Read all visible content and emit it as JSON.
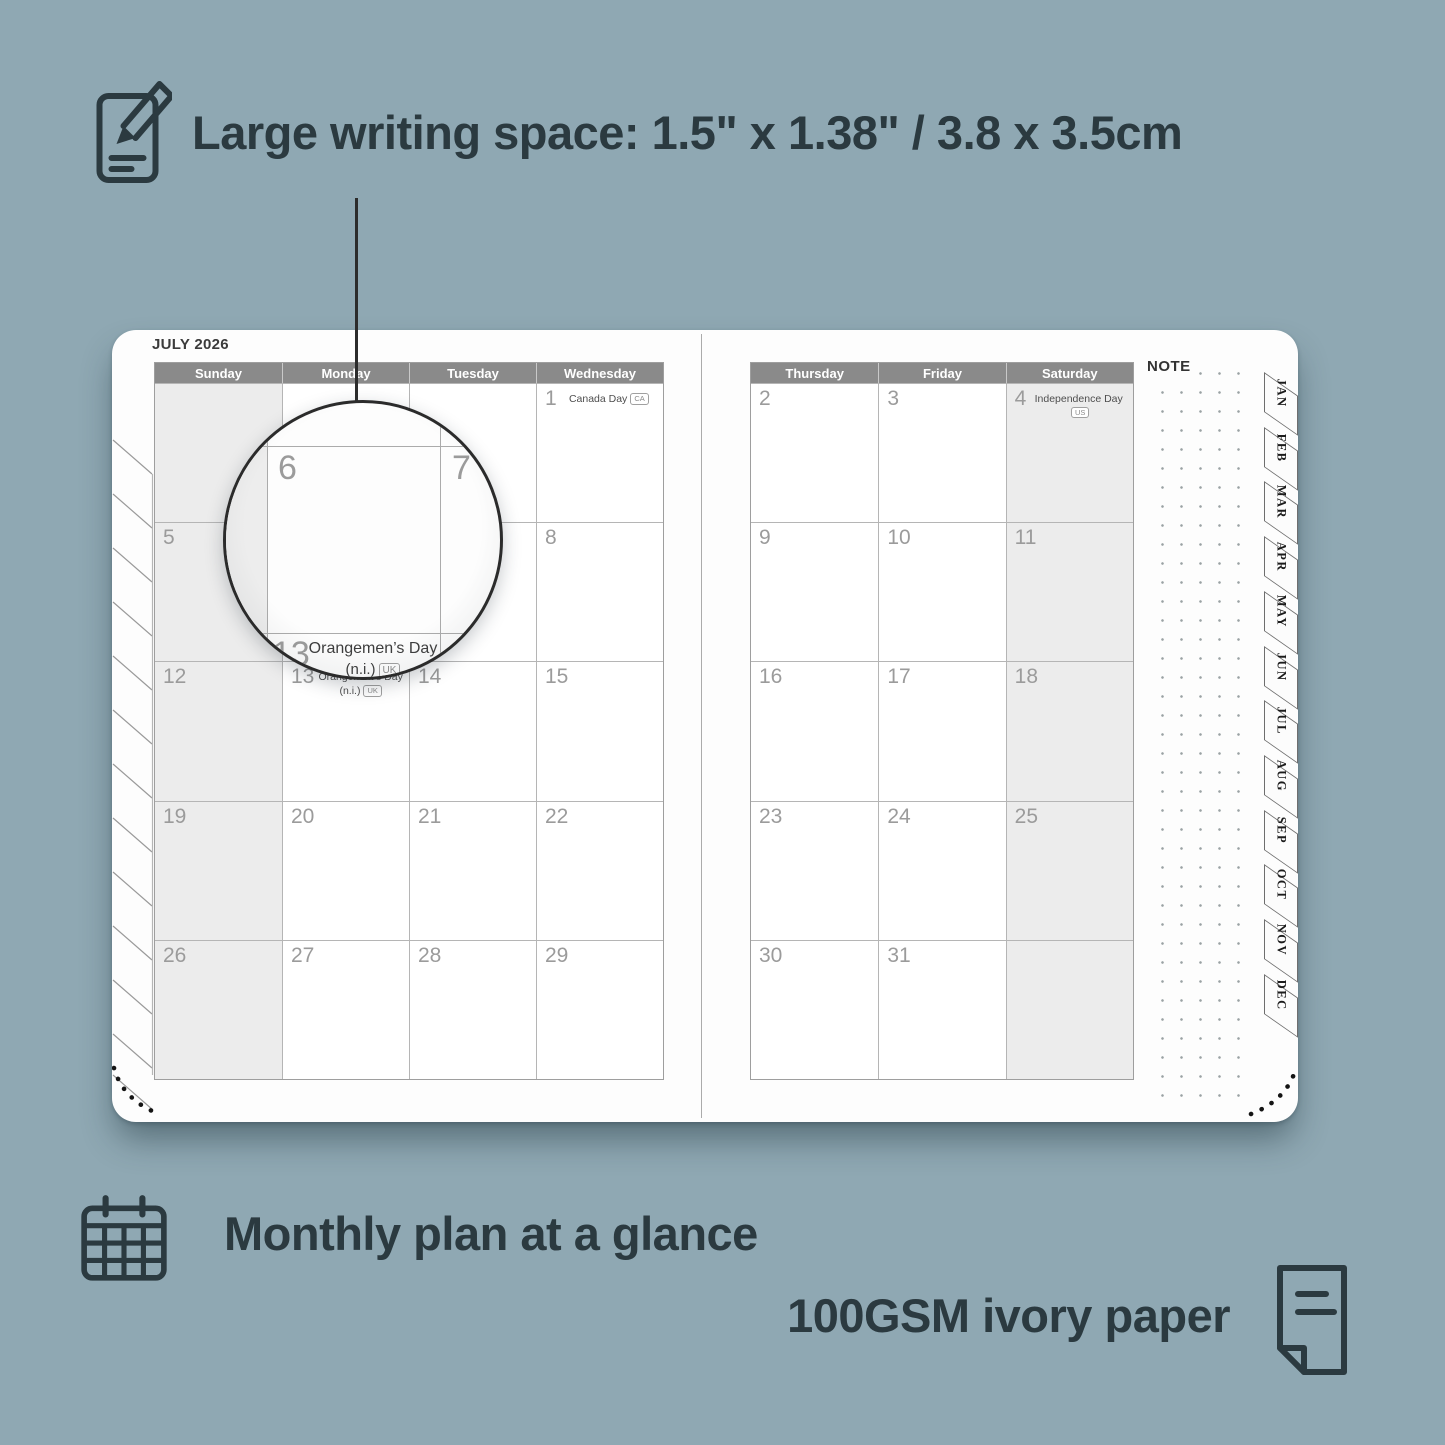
{
  "colors": {
    "background": "#8FA8B3",
    "ink": "#2B3A40",
    "header_bar": "#8A8A8A",
    "cell_shade": "#ECECEC",
    "page": "#FDFDFD"
  },
  "features": {
    "writing_space_label": "Large writing space: 1.5\" x 1.38\" / 3.8 x 3.5cm",
    "monthly_plan_label": "Monthly plan at a glance",
    "paper_label": "100GSM ivory paper"
  },
  "planner": {
    "month_title": "JULY 2026",
    "note_label": "NOTE",
    "left_day_headers": [
      "Sunday",
      "Monday",
      "Tuesday",
      "Wednesday"
    ],
    "right_day_headers": [
      "Thursday",
      "Friday",
      "Saturday"
    ],
    "month_tabs": [
      "JAN",
      "FEB",
      "MAR",
      "APR",
      "MAY",
      "JUN",
      "JUL",
      "AUG",
      "SEP",
      "OCT",
      "NOV",
      "DEC"
    ],
    "left_weeks": [
      [
        {
          "day": ""
        },
        {
          "day": ""
        },
        {
          "day": ""
        },
        {
          "day": "1",
          "holiday_lines": [
            "Canada Day"
          ],
          "badge": "CA"
        }
      ],
      [
        {
          "day": "5"
        },
        {
          "day": "6"
        },
        {
          "day": "7"
        },
        {
          "day": "8"
        }
      ],
      [
        {
          "day": "12"
        },
        {
          "day": "13",
          "holiday_lines": [
            "Orangemen’s Day",
            "(n.i.)"
          ],
          "badge": "UK"
        },
        {
          "day": "14"
        },
        {
          "day": "15"
        }
      ],
      [
        {
          "day": "19"
        },
        {
          "day": "20"
        },
        {
          "day": "21"
        },
        {
          "day": "22"
        }
      ],
      [
        {
          "day": "26"
        },
        {
          "day": "27"
        },
        {
          "day": "28"
        },
        {
          "day": "29"
        }
      ]
    ],
    "right_weeks": [
      [
        {
          "day": "2"
        },
        {
          "day": "3"
        },
        {
          "day": "4",
          "holiday_lines": [
            "Independence Day"
          ],
          "badge": "US"
        }
      ],
      [
        {
          "day": "9"
        },
        {
          "day": "10"
        },
        {
          "day": "11"
        }
      ],
      [
        {
          "day": "16"
        },
        {
          "day": "17"
        },
        {
          "day": "18"
        }
      ],
      [
        {
          "day": "23"
        },
        {
          "day": "24"
        },
        {
          "day": "25"
        }
      ],
      [
        {
          "day": "30"
        },
        {
          "day": "31"
        },
        {
          "day": ""
        }
      ]
    ],
    "magnifier": {
      "day_left": "6",
      "day_right": "7",
      "day_bottom": "13",
      "holiday_line1": "Orangemen’s Day",
      "holiday_line2": "(n.i.)",
      "badge": "UK"
    }
  }
}
